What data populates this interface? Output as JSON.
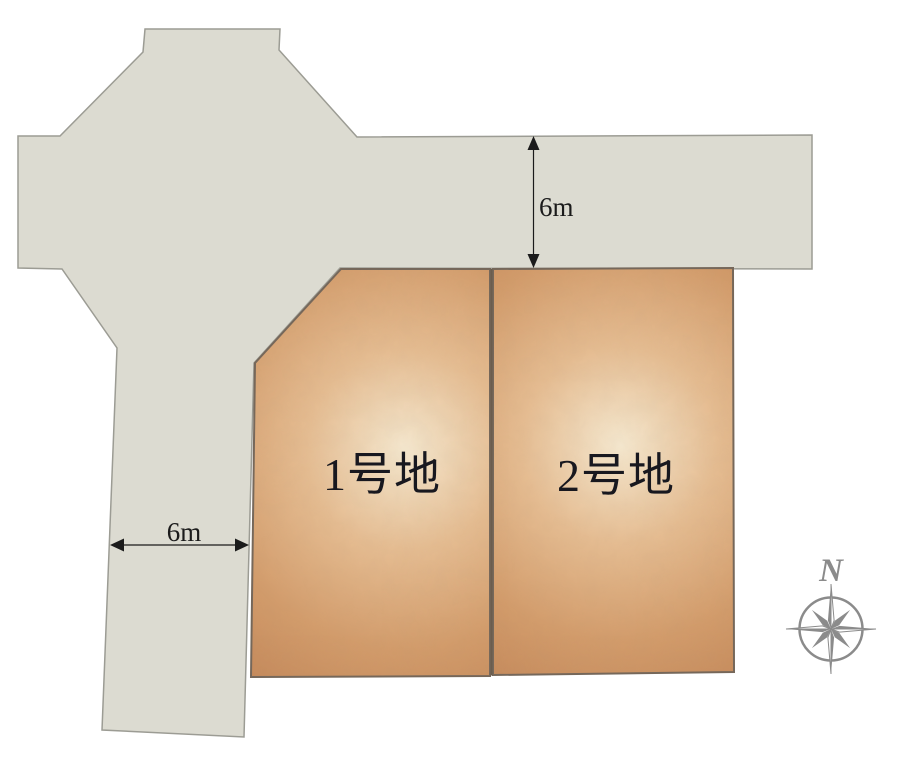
{
  "diagram": {
    "lots": [
      {
        "id": "lot-1",
        "label": "1号地"
      },
      {
        "id": "lot-2",
        "label": "2号地"
      }
    ],
    "dimensions": {
      "top_road_width": "6m",
      "left_road_width": "6m"
    },
    "compass": {
      "north_label": "N",
      "color": "#8b8b8b"
    },
    "colors": {
      "background": "#ffffff",
      "road_fill": "#dcdbd1",
      "road_stroke": "#9c9c94",
      "lot_fill_center": "#f6e9d0",
      "lot_fill_mid": "#e2b285",
      "lot_fill_edge": "#c4885a",
      "lot_stroke": "#75675a",
      "divider_line": "#6b5d4e",
      "dimension_ink": "#1b1b1b",
      "label_ink": "#18181f"
    }
  }
}
